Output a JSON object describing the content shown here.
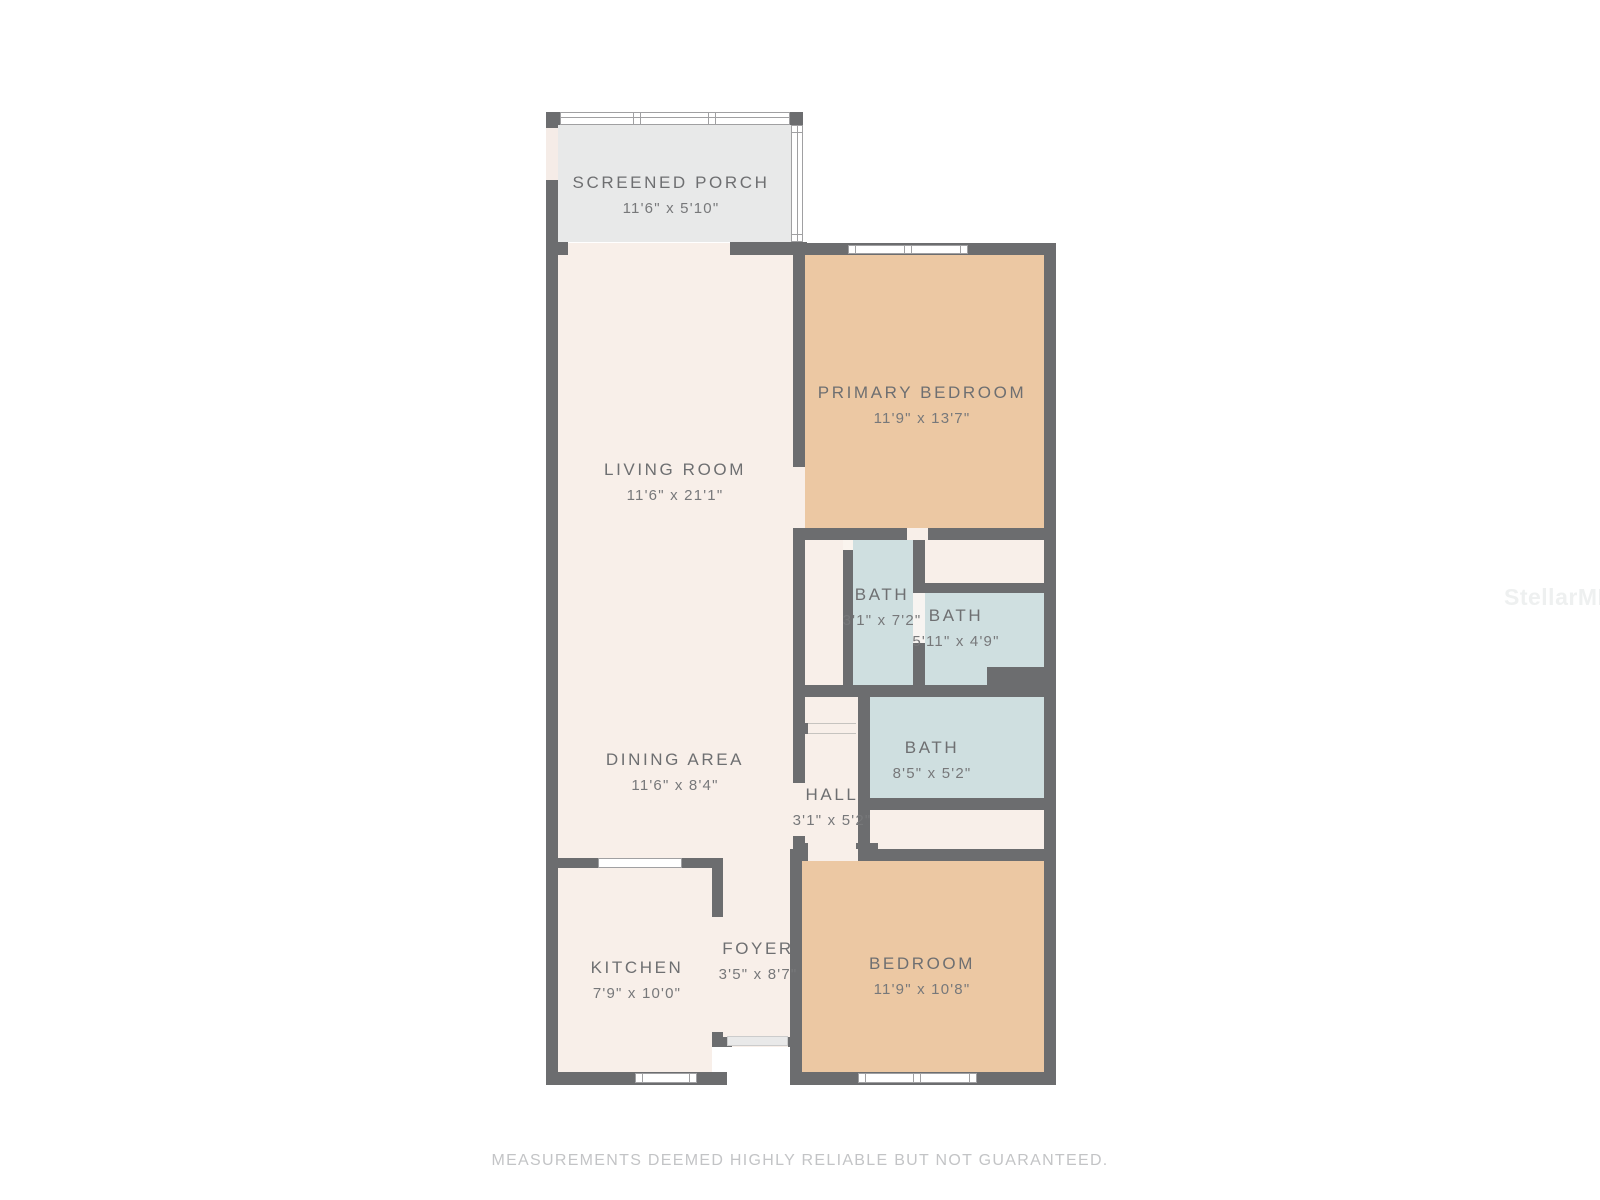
{
  "floorplan": {
    "rooms": [
      {
        "id": "screened-porch",
        "name": "SCREENED PORCH",
        "dims": "11'6\" x 5'10\""
      },
      {
        "id": "living-room",
        "name": "LIVING ROOM",
        "dims": "11'6\" x 21'1\""
      },
      {
        "id": "primary-bedroom",
        "name": "PRIMARY BEDROOM",
        "dims": "11'9\" x 13'7\""
      },
      {
        "id": "bath-1",
        "name": "BATH",
        "dims": "3'1\" x 7'2\""
      },
      {
        "id": "bath-2",
        "name": "BATH",
        "dims": "5'11\" x 4'9\""
      },
      {
        "id": "bath-3",
        "name": "BATH",
        "dims": "8'5\" x 5'2\""
      },
      {
        "id": "hall",
        "name": "HALL",
        "dims": "3'1\" x 5'2\""
      },
      {
        "id": "dining-area",
        "name": "DINING AREA",
        "dims": "11'6\" x 8'4\""
      },
      {
        "id": "kitchen",
        "name": "KITCHEN",
        "dims": "7'9\" x 10'0\""
      },
      {
        "id": "foyer",
        "name": "FOYER",
        "dims": "3'5\" x 8'7\""
      },
      {
        "id": "bedroom",
        "name": "BEDROOM",
        "dims": "11'9\" x 10'8\""
      }
    ],
    "colors": {
      "wall": "#6c6d6f",
      "floor": "#f8efe9",
      "bedroom_fill": "#ecc8a3",
      "bath_fill": "#cfdfe0",
      "porch_fill": "#e8e9e9",
      "label_text": "#6e6f71",
      "disclaimer_text": "#c3c4c6"
    },
    "footer": {
      "disclaimer": "MEASUREMENTS DEEMED HIGHLY RELIABLE BUT NOT GUARANTEED."
    },
    "watermark": {
      "text": "StellarMLS"
    }
  }
}
